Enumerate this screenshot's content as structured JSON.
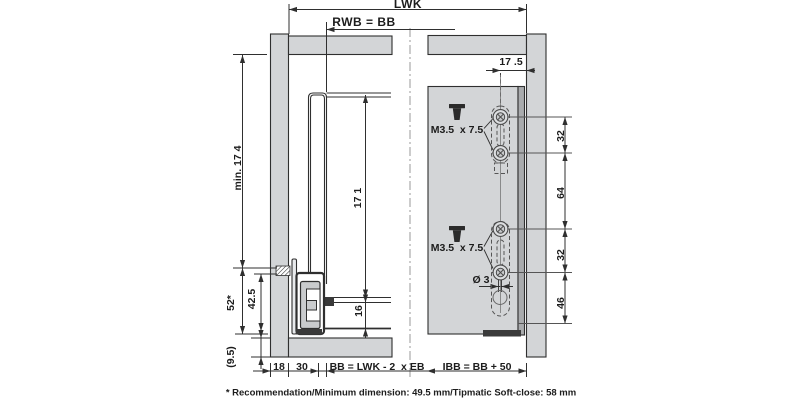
{
  "top_dims": {
    "lwk": "LWK",
    "rwb": "RWB = BB"
  },
  "left_view": {
    "min_height": "min. 17 4",
    "back_height": "17 1",
    "recess": "16",
    "install_height": "52*",
    "runner_height": "42.5",
    "bottom_thickness": "(9.5)",
    "side_gap": "18",
    "runner_offset": "30",
    "bb_formula": "BB = LWK - 2  x EB"
  },
  "right_view": {
    "top_offset": "17 .5",
    "screw_spec_upper": "M3.5  x 7.5",
    "screw_spec_lower": "M3.5  x 7.5",
    "hole_dia": "Ø 3",
    "pitch_1": "32",
    "pitch_2": "64",
    "pitch_3": "32",
    "pitch_4": "46",
    "ibb_formula": "IBB = BB + 50"
  },
  "footnote": "* Recommendation/Minimum dimension: 49.5 mm/Tipmatic Soft-close: 58 mm",
  "colors": {
    "panel": "#d3d5d7",
    "panel_edge": "#a9abad",
    "line": "#2f2f2f",
    "dark_fill": "#3a3a3a"
  }
}
